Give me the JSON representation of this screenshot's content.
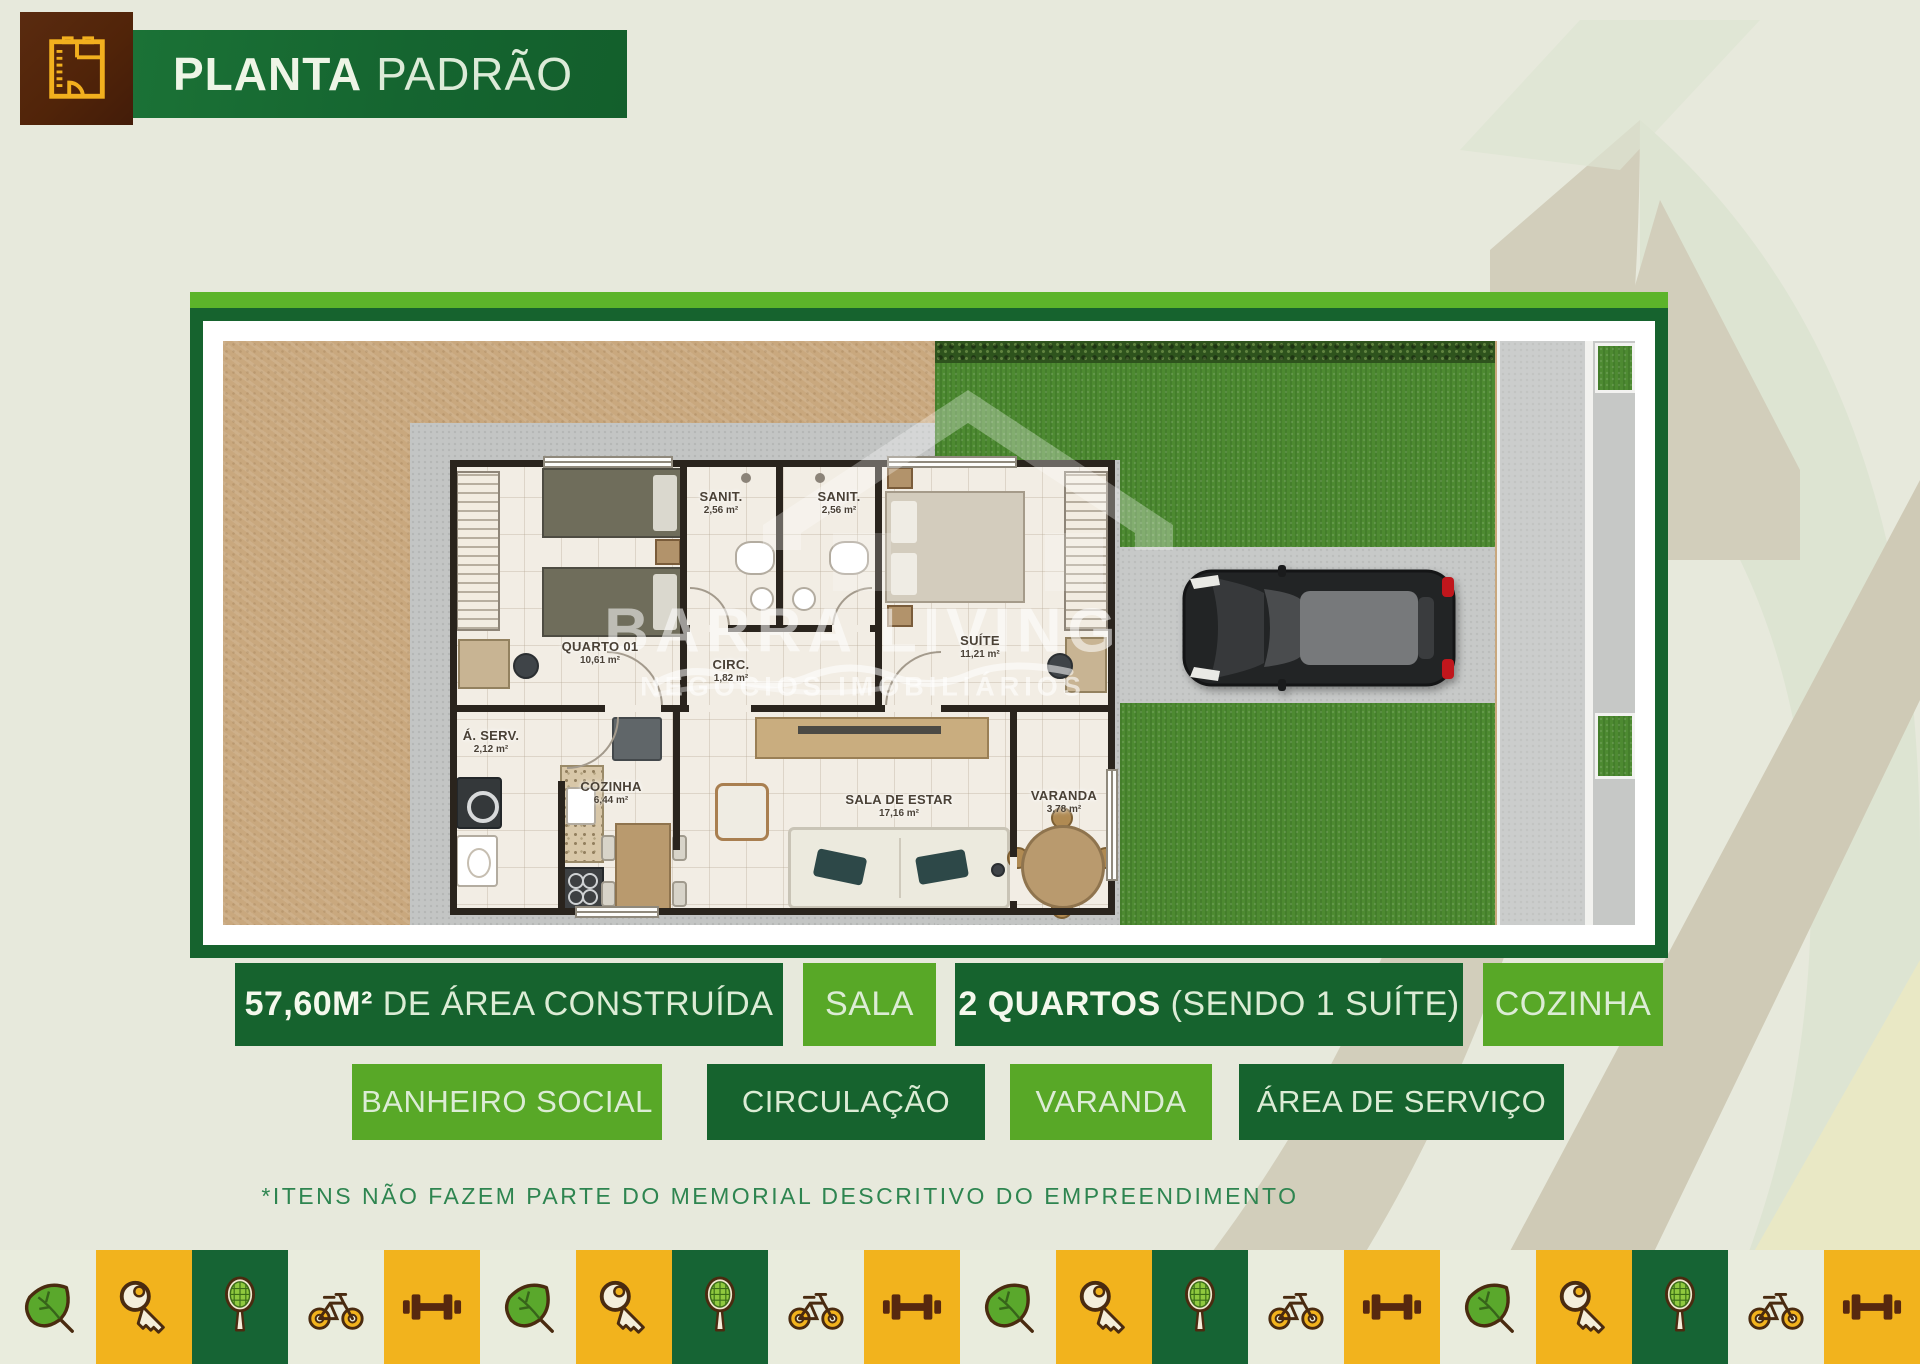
{
  "header": {
    "title_bold": "PLANTA",
    "title_light": "PADRÃO"
  },
  "floor_plan": {
    "watermark": {
      "brand": "BARRA LIVING",
      "tagline": "NEGÓCIOS IMOBILIÁRIOS"
    },
    "rooms": [
      {
        "id": "quarto01",
        "name": "QUARTO 01",
        "area": "10,61 m²",
        "cx": 377,
        "cy": 312
      },
      {
        "id": "sanit1",
        "name": "SANIT.",
        "area": "2,56 m²",
        "cx": 498,
        "cy": 162
      },
      {
        "id": "sanit2",
        "name": "SANIT.",
        "area": "2,56 m²",
        "cx": 616,
        "cy": 162
      },
      {
        "id": "circ",
        "name": "CIRC.",
        "area": "1,82 m²",
        "cx": 508,
        "cy": 330
      },
      {
        "id": "suite",
        "name": "SUÍTE",
        "area": "11,21 m²",
        "cx": 757,
        "cy": 306
      },
      {
        "id": "aserv",
        "name": "Á. SERV.",
        "area": "2,12 m²",
        "cx": 268,
        "cy": 401
      },
      {
        "id": "cozinha",
        "name": "COZINHA",
        "area": "6,44 m²",
        "cx": 388,
        "cy": 452
      },
      {
        "id": "sala",
        "name": "SALA DE ESTAR",
        "area": "17,16 m²",
        "cx": 676,
        "cy": 465
      },
      {
        "id": "varanda",
        "name": "VARANDA",
        "area": "3,78 m²",
        "cx": 841,
        "cy": 461
      }
    ]
  },
  "features": {
    "row1": [
      {
        "id": "area-construida",
        "x": 235,
        "w": 548,
        "tone": "dark",
        "label_bold": "57,60M²",
        "label": " DE ÁREA CONSTRUÍDA"
      },
      {
        "id": "sala",
        "x": 803,
        "w": 133,
        "tone": "light",
        "label_bold": "",
        "label": "SALA"
      },
      {
        "id": "quartos",
        "x": 955,
        "w": 508,
        "tone": "dark",
        "label_bold": "2 QUARTOS",
        "label": " (SENDO 1 SUÍTE)"
      },
      {
        "id": "cozinha",
        "x": 1483,
        "w": 180,
        "tone": "light",
        "label_bold": "",
        "label": "COZINHA"
      }
    ],
    "row2": [
      {
        "id": "banheiro-social",
        "x": 352,
        "w": 310,
        "tone": "light",
        "label_bold": "",
        "label": "BANHEIRO SOCIAL"
      },
      {
        "id": "circulacao",
        "x": 707,
        "w": 278,
        "tone": "dark",
        "label_bold": "",
        "label": "CIRCULAÇÃO"
      },
      {
        "id": "varanda",
        "x": 1010,
        "w": 202,
        "tone": "light",
        "label_bold": "",
        "label": "VARANDA"
      },
      {
        "id": "area-servico",
        "x": 1239,
        "w": 325,
        "tone": "dark",
        "label_bold": "",
        "label": "ÁREA DE SERVIÇO"
      }
    ]
  },
  "disclaimer": "*ITENS NÃO FAZEM PARTE DO MEMORIAL DESCRITIVO DO EMPREENDIMENTO",
  "footer_strip": {
    "cells": [
      {
        "icon": "leaf",
        "bg": "cream"
      },
      {
        "icon": "key",
        "bg": "yellow"
      },
      {
        "icon": "racket",
        "bg": "green"
      },
      {
        "icon": "bike",
        "bg": "cream"
      },
      {
        "icon": "dumbbell",
        "bg": "yellow"
      },
      {
        "icon": "leaf",
        "bg": "cream"
      },
      {
        "icon": "key",
        "bg": "yellow"
      },
      {
        "icon": "racket",
        "bg": "green"
      },
      {
        "icon": "bike",
        "bg": "cream"
      },
      {
        "icon": "dumbbell",
        "bg": "yellow"
      },
      {
        "icon": "leaf",
        "bg": "cream"
      },
      {
        "icon": "key",
        "bg": "yellow"
      },
      {
        "icon": "racket",
        "bg": "green"
      },
      {
        "icon": "bike",
        "bg": "cream"
      },
      {
        "icon": "dumbbell",
        "bg": "yellow"
      },
      {
        "icon": "leaf",
        "bg": "cream"
      },
      {
        "icon": "key",
        "bg": "yellow"
      },
      {
        "icon": "racket",
        "bg": "green"
      },
      {
        "icon": "bike",
        "bg": "cream"
      },
      {
        "icon": "dumbbell",
        "bg": "yellow"
      }
    ]
  },
  "colors": {
    "page_bg": "#e7e9dc",
    "dark_green": "#16632e",
    "light_green": "#58a827",
    "bright_green": "#5cb42a",
    "yellow": "#f2b31d",
    "brown": "#4f2310",
    "cream": "#e9f2e2"
  }
}
